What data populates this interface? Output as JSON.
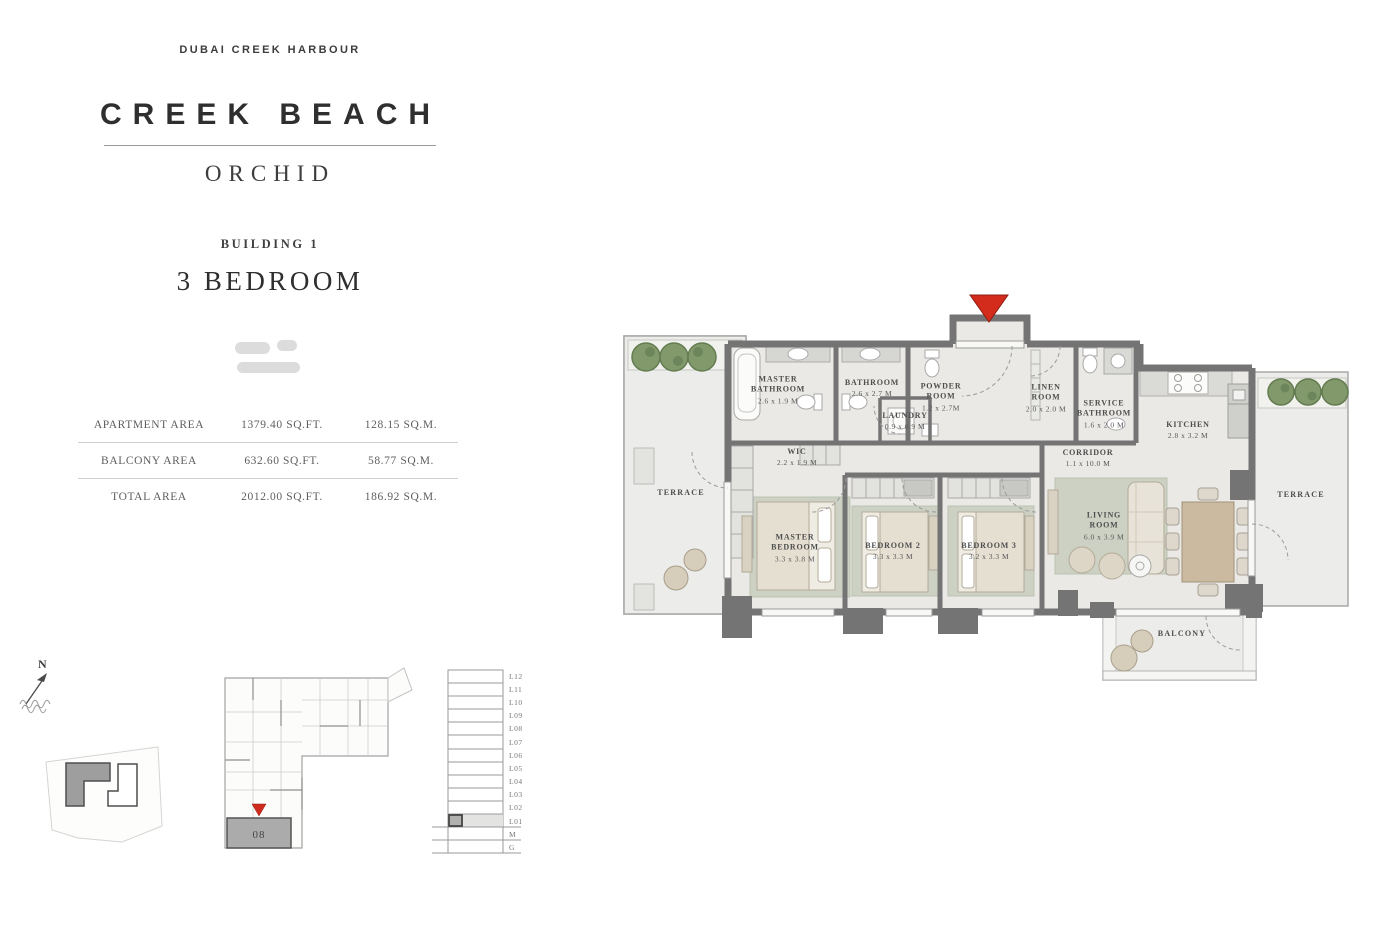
{
  "header": {
    "brand": "DUBAI CREEK HARBOUR",
    "project": "CREEK BEACH",
    "collection": "ORCHID",
    "building": "BUILDING 1",
    "unit_type": "3 BEDROOM"
  },
  "area_table": {
    "rows": [
      {
        "label": "APARTMENT AREA",
        "sqft": "1379.40 SQ.FT.",
        "sqm": "128.15 SQ.M."
      },
      {
        "label": "BALCONY AREA",
        "sqft": "632.60 SQ.FT.",
        "sqm": "58.77 SQ.M."
      },
      {
        "label": "TOTAL AREA",
        "sqft": "2012.00 SQ.FT.",
        "sqm": "186.92 SQ.M."
      }
    ]
  },
  "floorplan": {
    "rooms": [
      {
        "name": "MASTER BATHROOM",
        "dim": "2.6 x 1.9 M"
      },
      {
        "name": "BATHROOM",
        "dim": "2.6 x 2.7 M"
      },
      {
        "name": "POWDER ROOM",
        "dim": "1.2 x 2.7M"
      },
      {
        "name": "LAUNDRY",
        "dim": "0.9 x 0.9 M"
      },
      {
        "name": "LINEN ROOM",
        "dim": "2.0 x 2.0 M"
      },
      {
        "name": "SERVICE BATHROOM",
        "dim": "1.6 x 2.0 M"
      },
      {
        "name": "KITCHEN",
        "dim": "2.8 x 3.2 M"
      },
      {
        "name": "WIC",
        "dim": "2.2 x 1.9 M"
      },
      {
        "name": "CORRIDOR",
        "dim": "1.1 x 10.0 M"
      },
      {
        "name": "MASTER BEDROOM",
        "dim": "3.3 x 3.8 M"
      },
      {
        "name": "BEDROOM 2",
        "dim": "3.3 x 3.3 M"
      },
      {
        "name": "BEDROOM 3",
        "dim": "3.2 x 3.3 M"
      },
      {
        "name": "LIVING ROOM",
        "dim": "6.0 x 3.9 M"
      },
      {
        "name": "TERRACE",
        "dim": ""
      },
      {
        "name": "TERRACE",
        "dim": ""
      },
      {
        "name": "BALCONY",
        "dim": ""
      }
    ]
  },
  "key_plan": {
    "unit_number": "08"
  },
  "levels": {
    "list": [
      "L12",
      "L11",
      "L10",
      "L09",
      "L08",
      "L07",
      "L06",
      "L05",
      "L04",
      "L03",
      "L02",
      "L01",
      "M",
      "G"
    ]
  },
  "compass": {
    "north_label": "N"
  },
  "colors": {
    "accent_red": "#d32b1c",
    "wall_gray": "#747474",
    "floor": "#eae9e6",
    "rug_green": "#ccd1c3",
    "tree_green": "#82996b",
    "furniture_beige": "#e6dfd2"
  }
}
